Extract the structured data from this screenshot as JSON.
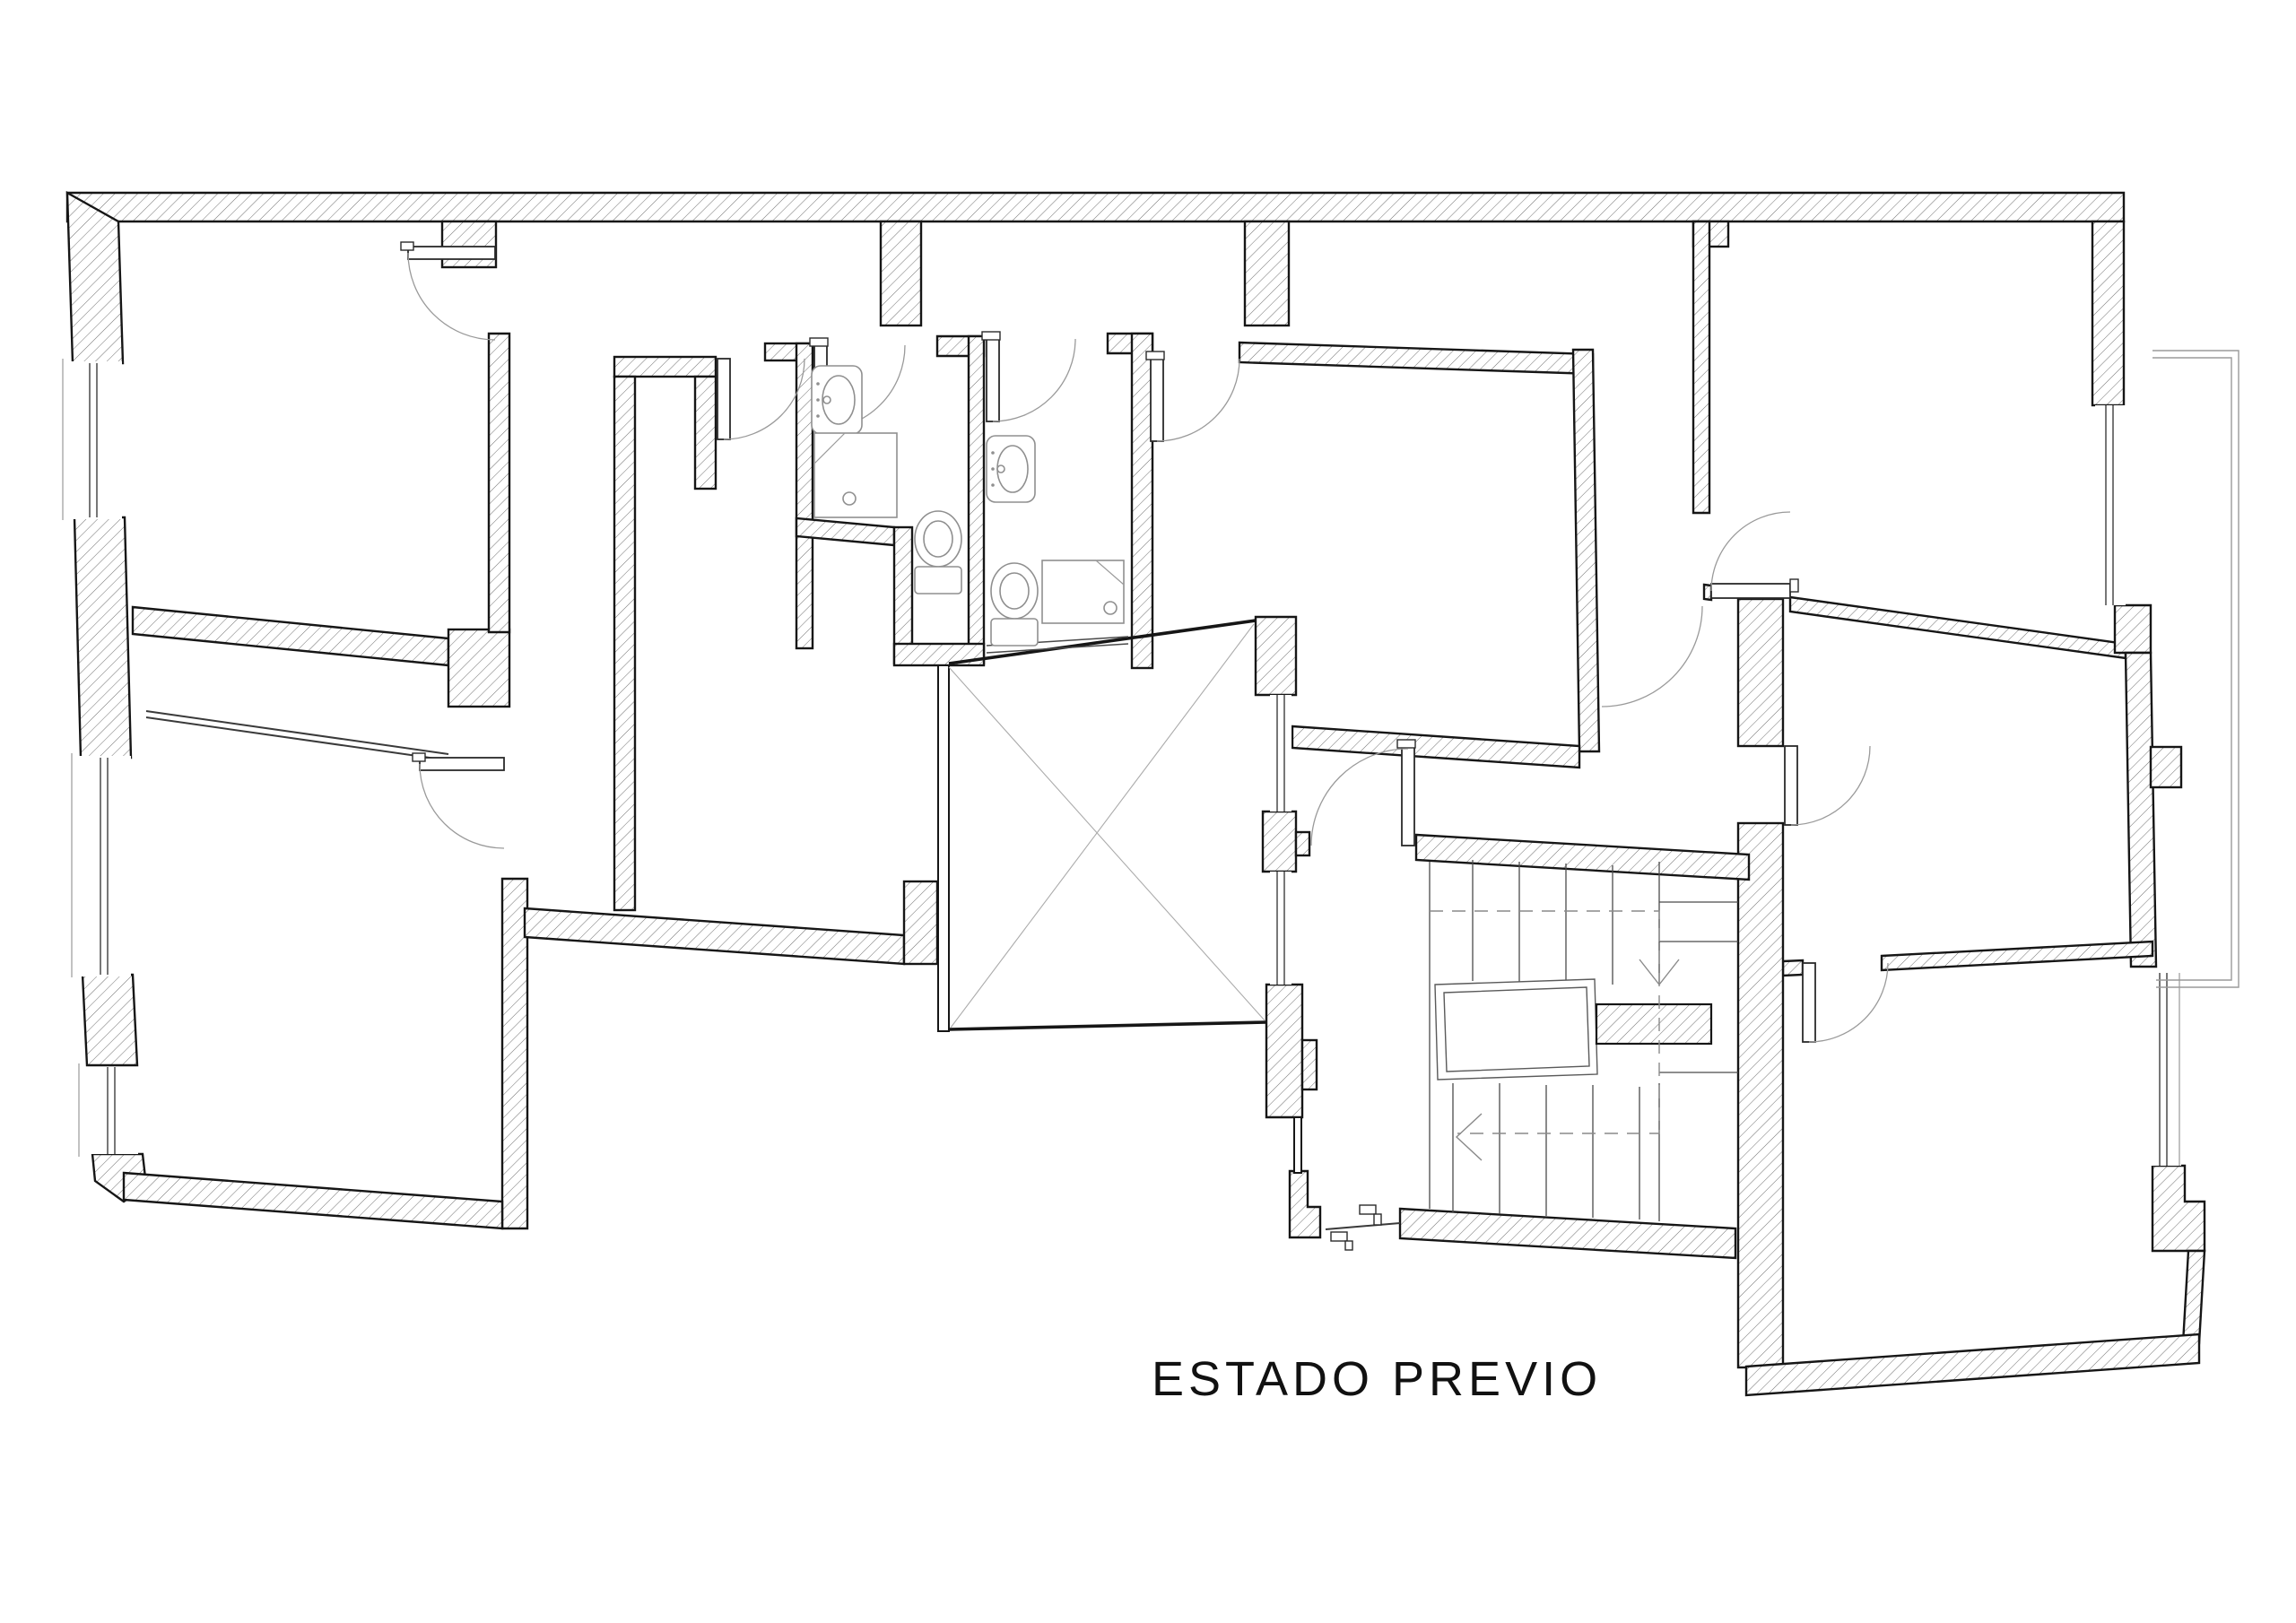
{
  "title": {
    "label": "ESTADO PREVIO"
  },
  "drawing": {
    "type": "floor-plan",
    "background_color": "#ffffff",
    "wall_line_color": "#161616",
    "hatch_line_color": "#707070",
    "swing_arc_color": "#9a9a9a",
    "annotation_color": "#8a8a8a"
  },
  "symbols": {
    "bathroom_a": [
      "sink",
      "shower-tray",
      "toilet"
    ],
    "bathroom_b": [
      "sink",
      "shower-tray",
      "toilet"
    ],
    "stair": {
      "upper_flight_treads": 6,
      "lower_flight_treads": 6,
      "direction_arrows": [
        "down",
        "left"
      ],
      "has_dashed_walk_line": true,
      "has_central_void": true
    },
    "patio": {
      "has_diagonal_cross": true
    },
    "balcony": {
      "outline": "double-line"
    },
    "door_swings": 11,
    "windows": 8
  }
}
